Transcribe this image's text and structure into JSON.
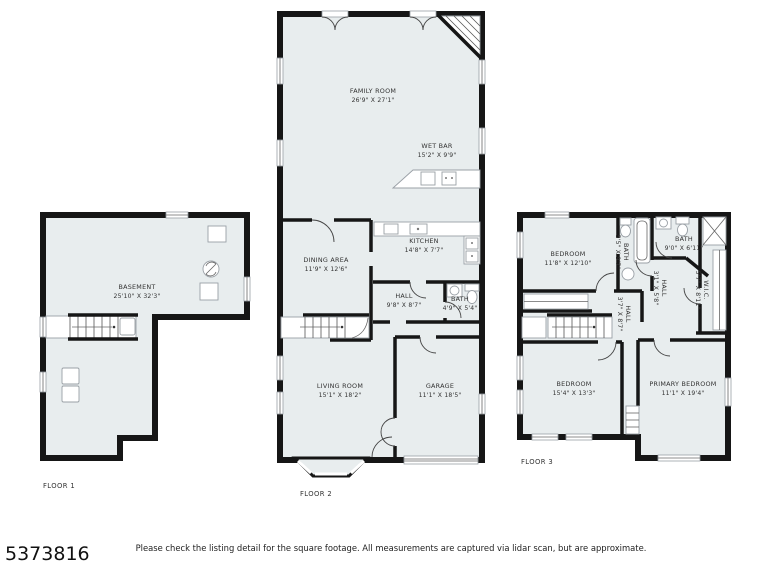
{
  "page": {
    "listing_id": "5373816",
    "disclaimer": "Please check the listing detail for the square footage. All measurements are captured via lidar scan, but are approximate."
  },
  "colors": {
    "wall": "#161616",
    "room_fill": "#e8edee",
    "fixture_stroke": "#9aa0a6",
    "text": "#333333",
    "background": "#ffffff"
  },
  "floors": [
    {
      "id": "floor-1",
      "label": "FLOOR 1",
      "rooms": [
        {
          "name": "BASEMENT",
          "dims": "25'10\" X 32'3\""
        }
      ]
    },
    {
      "id": "floor-2",
      "label": "FLOOR 2",
      "rooms": [
        {
          "name": "FAMILY ROOM",
          "dims": "26'9\" X 27'1\""
        },
        {
          "name": "WET BAR",
          "dims": "15'2\" X 9'9\""
        },
        {
          "name": "KITCHEN",
          "dims": "14'8\" X 7'7\""
        },
        {
          "name": "DINING AREA",
          "dims": "11'9\" X 12'6\""
        },
        {
          "name": "HALL",
          "dims": "9'8\" X 8'7\""
        },
        {
          "name": "BATH",
          "dims": "4'9\" X 5'4\""
        },
        {
          "name": "LIVING ROOM",
          "dims": "15'1\" X 18'2\""
        },
        {
          "name": "GARAGE",
          "dims": "11'1\" X 18'5\""
        }
      ]
    },
    {
      "id": "floor-3",
      "label": "FLOOR 3",
      "rooms": [
        {
          "name": "BEDROOM",
          "dims": "11'8\" X 12'10\""
        },
        {
          "name": "BATH",
          "dims": "5'5\" X 9'7\""
        },
        {
          "name": "BATH",
          "dims": "9'0\" X 6'11\""
        },
        {
          "name": "W.I.C.",
          "dims": "5'7\" X 8'11\""
        },
        {
          "name": "HALL",
          "dims": "3'1\" X 5'8\""
        },
        {
          "name": "HALL",
          "dims": "3'7\" X 8'7\""
        },
        {
          "name": "BEDROOM",
          "dims": "15'4\" X 13'3\""
        },
        {
          "name": "PRIMARY BEDROOM",
          "dims": "11'1\" X 19'4\""
        }
      ]
    }
  ]
}
